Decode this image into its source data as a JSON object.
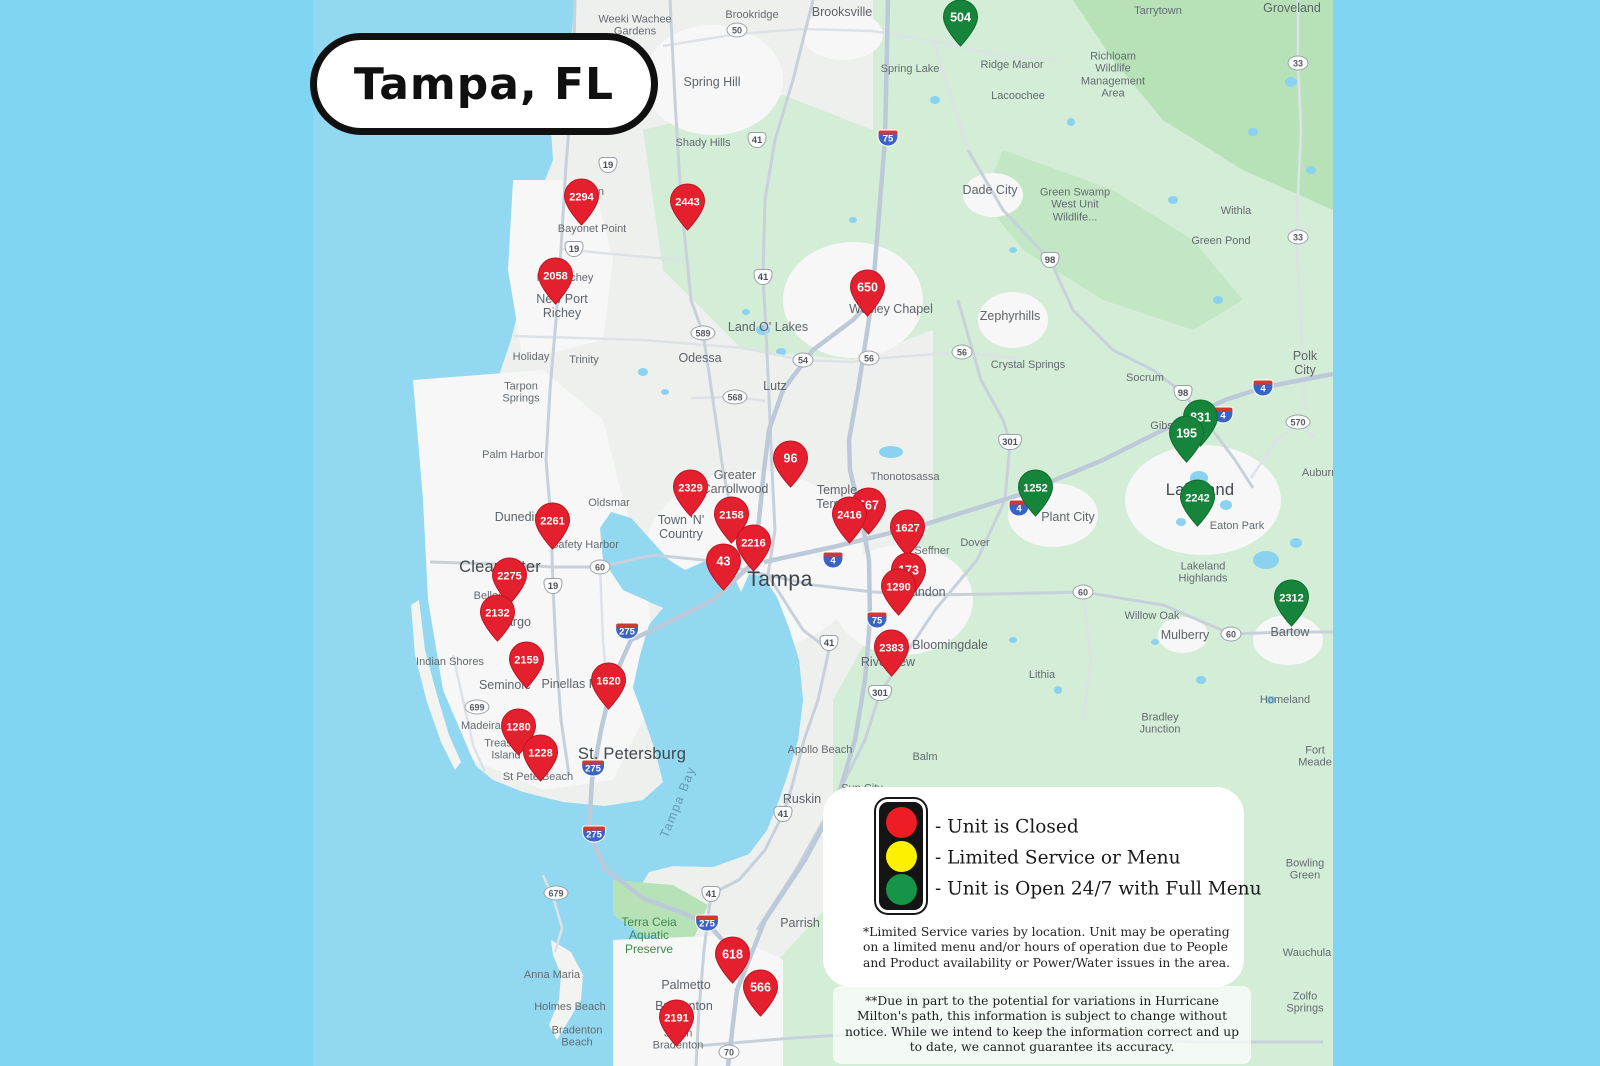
{
  "title_badge": "Tampa, FL",
  "colors": {
    "page_bg": "#7fd5f2",
    "ocean": "#92d8f1",
    "land": "#eef0ee",
    "rural_green": "#d4edd6",
    "park_green": "#b7e2b8",
    "urban": "#f6f7f6",
    "road": "#c7d1dc",
    "road_minor": "#dde2e8",
    "pin": {
      "closed": {
        "fill": "#e4202e",
        "stroke": "#bf1322"
      },
      "open": {
        "fill": "#17843b",
        "stroke": "#0e6b2e"
      }
    }
  },
  "legend": {
    "items": [
      {
        "light": "red",
        "color": "#ee1c24",
        "label": "- Unit is Closed"
      },
      {
        "light": "yellow",
        "color": "#fdf000",
        "label": "- Limited Service or Menu"
      },
      {
        "light": "green",
        "color": "#169447",
        "label": "- Unit is Open 24/7 with Full Menu"
      }
    ],
    "footnote_limited": "*Limited Service varies by location. Unit may be operating on a limited menu and/or hours of operation due to People and Product availability or Power/Water issues in the area.",
    "footnote_hurricane": "**Due in part to the potential for variations in Hurricane Milton's path, this information is subject to change without notice. While we intend to keep the information correct and up to date, we cannot guarantee its accuracy."
  },
  "pins": [
    {
      "id": "504",
      "status": "open",
      "x": 960,
      "y": 17
    },
    {
      "id": "2294",
      "status": "closed",
      "x": 581,
      "y": 196
    },
    {
      "id": "2443",
      "status": "closed",
      "x": 687,
      "y": 201
    },
    {
      "id": "2058",
      "status": "closed",
      "x": 555,
      "y": 275
    },
    {
      "id": "650",
      "status": "closed",
      "x": 867,
      "y": 287
    },
    {
      "id": "831",
      "status": "open",
      "x": 1200,
      "y": 417
    },
    {
      "id": "195",
      "status": "open",
      "x": 1186,
      "y": 433
    },
    {
      "id": "96",
      "status": "closed",
      "x": 790,
      "y": 458
    },
    {
      "id": "1252",
      "status": "open",
      "x": 1035,
      "y": 487
    },
    {
      "id": "2329",
      "status": "closed",
      "x": 690,
      "y": 487
    },
    {
      "id": "2242",
      "status": "open",
      "x": 1197,
      "y": 497
    },
    {
      "id": "567",
      "status": "closed",
      "x": 868,
      "y": 505
    },
    {
      "id": "2416",
      "status": "closed",
      "x": 849,
      "y": 514
    },
    {
      "id": "2158",
      "status": "closed",
      "x": 731,
      "y": 514
    },
    {
      "id": "2261",
      "status": "closed",
      "x": 552,
      "y": 520
    },
    {
      "id": "1627",
      "status": "closed",
      "x": 907,
      "y": 527
    },
    {
      "id": "2216",
      "status": "closed",
      "x": 753,
      "y": 542
    },
    {
      "id": "43",
      "status": "closed",
      "x": 723,
      "y": 561
    },
    {
      "id": "173",
      "status": "closed",
      "x": 908,
      "y": 570
    },
    {
      "id": "2275",
      "status": "closed",
      "x": 509,
      "y": 575
    },
    {
      "id": "1290",
      "status": "closed",
      "x": 898,
      "y": 586
    },
    {
      "id": "2312",
      "status": "open",
      "x": 1291,
      "y": 597
    },
    {
      "id": "2132",
      "status": "closed",
      "x": 497,
      "y": 612
    },
    {
      "id": "2383",
      "status": "closed",
      "x": 891,
      "y": 647
    },
    {
      "id": "2159",
      "status": "closed",
      "x": 526,
      "y": 659
    },
    {
      "id": "1620",
      "status": "closed",
      "x": 608,
      "y": 680
    },
    {
      "id": "1280",
      "status": "closed",
      "x": 518,
      "y": 726
    },
    {
      "id": "1228",
      "status": "closed",
      "x": 540,
      "y": 752
    },
    {
      "id": "618",
      "status": "closed",
      "x": 732,
      "y": 954
    },
    {
      "id": "566",
      "status": "closed",
      "x": 760,
      "y": 987
    },
    {
      "id": "2191",
      "status": "closed",
      "x": 676,
      "y": 1017
    }
  ],
  "map_labels": [
    {
      "text": "Weeki Wachee\nGardens",
      "x": 635,
      "y": 26,
      "cls": "s"
    },
    {
      "text": "Brookridge",
      "x": 752,
      "y": 15,
      "cls": "s"
    },
    {
      "text": "Brooksville",
      "x": 842,
      "y": 12,
      "cls": "m"
    },
    {
      "text": "Tarrytown",
      "x": 1158,
      "y": 11,
      "cls": "s"
    },
    {
      "text": "Groveland",
      "x": 1292,
      "y": 8,
      "cls": "m"
    },
    {
      "text": "Richloam\nWildlife\nManagement\nArea",
      "x": 1113,
      "y": 75,
      "cls": "s"
    },
    {
      "text": "Spring Hill",
      "x": 712,
      "y": 82,
      "cls": "m"
    },
    {
      "text": "Spring Lake",
      "x": 910,
      "y": 69,
      "cls": "s"
    },
    {
      "text": "Ridge Manor",
      "x": 1012,
      "y": 65,
      "cls": "s"
    },
    {
      "text": "Lacoochee",
      "x": 1018,
      "y": 96,
      "cls": "s"
    },
    {
      "text": "Shady Hills",
      "x": 703,
      "y": 143,
      "cls": "s"
    },
    {
      "text": "Dade City",
      "x": 990,
      "y": 190,
      "cls": "m"
    },
    {
      "text": "Green Swamp\nWest Unit\nWildlife...",
      "x": 1075,
      "y": 205,
      "cls": "s"
    },
    {
      "text": "Withla",
      "x": 1236,
      "y": 211,
      "cls": "s"
    },
    {
      "text": "Green Pond",
      "x": 1221,
      "y": 241,
      "cls": "s"
    },
    {
      "text": "Hudson",
      "x": 585,
      "y": 192,
      "cls": "s"
    },
    {
      "text": "Bayonet Point",
      "x": 592,
      "y": 229,
      "cls": "s"
    },
    {
      "text": "Port Richey",
      "x": 565,
      "y": 278,
      "cls": "s"
    },
    {
      "text": "New Port\nRichey",
      "x": 562,
      "y": 306,
      "cls": "m"
    },
    {
      "text": "Wesley Chapel",
      "x": 891,
      "y": 309,
      "cls": "m"
    },
    {
      "text": "Zephyrhills",
      "x": 1010,
      "y": 316,
      "cls": "m"
    },
    {
      "text": "Land O' Lakes",
      "x": 768,
      "y": 327,
      "cls": "m"
    },
    {
      "text": "Odessa",
      "x": 700,
      "y": 358,
      "cls": "m"
    },
    {
      "text": "Holiday",
      "x": 531,
      "y": 357,
      "cls": "s"
    },
    {
      "text": "Trinity",
      "x": 584,
      "y": 360,
      "cls": "s"
    },
    {
      "text": "Crystal Springs",
      "x": 1028,
      "y": 365,
      "cls": "s"
    },
    {
      "text": "Socrum",
      "x": 1145,
      "y": 378,
      "cls": "s"
    },
    {
      "text": "Polk City",
      "x": 1305,
      "y": 363,
      "cls": "m"
    },
    {
      "text": "Tarpon\nSprings",
      "x": 521,
      "y": 393,
      "cls": "s"
    },
    {
      "text": "Lutz",
      "x": 775,
      "y": 386,
      "cls": "m"
    },
    {
      "text": "Palm Harbor",
      "x": 513,
      "y": 455,
      "cls": "s"
    },
    {
      "text": "Thonotosassa",
      "x": 905,
      "y": 477,
      "cls": "s"
    },
    {
      "text": "Greater\nCarrollwood",
      "x": 735,
      "y": 482,
      "cls": "m"
    },
    {
      "text": "Oldsmar",
      "x": 609,
      "y": 503,
      "cls": "s"
    },
    {
      "text": "Temple\nTerrace",
      "x": 837,
      "y": 497,
      "cls": "m"
    },
    {
      "text": "Gibsonia",
      "x": 1172,
      "y": 426,
      "cls": "s"
    },
    {
      "text": "Plant City",
      "x": 1068,
      "y": 517,
      "cls": "m"
    },
    {
      "text": "Lakeland",
      "x": 1200,
      "y": 490,
      "cls": "l"
    },
    {
      "text": "Eaton Park",
      "x": 1237,
      "y": 526,
      "cls": "s"
    },
    {
      "text": "Town 'N'\nCountry",
      "x": 681,
      "y": 527,
      "cls": "m"
    },
    {
      "text": "Dunedin",
      "x": 518,
      "y": 517,
      "cls": "m"
    },
    {
      "text": "Safety Harbor",
      "x": 585,
      "y": 545,
      "cls": "s"
    },
    {
      "text": "Seffner",
      "x": 932,
      "y": 551,
      "cls": "s"
    },
    {
      "text": "Dover",
      "x": 975,
      "y": 543,
      "cls": "s"
    },
    {
      "text": "Clearwater",
      "x": 500,
      "y": 567,
      "cls": "l"
    },
    {
      "text": "Tampa",
      "x": 780,
      "y": 580,
      "cls": "xl"
    },
    {
      "text": "Belleair",
      "x": 492,
      "y": 596,
      "cls": "s"
    },
    {
      "text": "Largo",
      "x": 515,
      "y": 622,
      "cls": "m"
    },
    {
      "text": "Brandon",
      "x": 922,
      "y": 592,
      "cls": "m"
    },
    {
      "text": "Willow Oak",
      "x": 1152,
      "y": 616,
      "cls": "s"
    },
    {
      "text": "Mulberry",
      "x": 1185,
      "y": 635,
      "cls": "m"
    },
    {
      "text": "Bartow",
      "x": 1290,
      "y": 632,
      "cls": "m"
    },
    {
      "text": "Lakeland\nHighlands",
      "x": 1203,
      "y": 573,
      "cls": "s"
    },
    {
      "text": "Auburndale",
      "x": 1330,
      "y": 473,
      "cls": "s"
    },
    {
      "text": "Indian Shores",
      "x": 450,
      "y": 662,
      "cls": "s"
    },
    {
      "text": "Seminole",
      "x": 505,
      "y": 685,
      "cls": "m"
    },
    {
      "text": "Pinellas Park",
      "x": 578,
      "y": 684,
      "cls": "m"
    },
    {
      "text": "Bloomingdale",
      "x": 950,
      "y": 645,
      "cls": "m"
    },
    {
      "text": "Riverview",
      "x": 888,
      "y": 662,
      "cls": "m"
    },
    {
      "text": "Lithia",
      "x": 1042,
      "y": 675,
      "cls": "s"
    },
    {
      "text": "Madeira Beach",
      "x": 498,
      "y": 726,
      "cls": "s"
    },
    {
      "text": "St. Petersburg",
      "x": 632,
      "y": 754,
      "cls": "l"
    },
    {
      "text": "Treasure\nIsland",
      "x": 506,
      "y": 750,
      "cls": "s"
    },
    {
      "text": "St Pete Beach",
      "x": 538,
      "y": 777,
      "cls": "s"
    },
    {
      "text": "Apollo Beach",
      "x": 820,
      "y": 750,
      "cls": "s"
    },
    {
      "text": "Balm",
      "x": 925,
      "y": 757,
      "cls": "s"
    },
    {
      "text": "Homeland",
      "x": 1285,
      "y": 700,
      "cls": "s"
    },
    {
      "text": "Bradley\nJunction",
      "x": 1160,
      "y": 724,
      "cls": "s"
    },
    {
      "text": "Fort Meade",
      "x": 1315,
      "y": 757,
      "cls": "s"
    },
    {
      "text": "Sun City\nCenter",
      "x": 862,
      "y": 795,
      "cls": "s"
    },
    {
      "text": "Ruskin",
      "x": 802,
      "y": 799,
      "cls": "m"
    },
    {
      "text": "Terra Ceia\nAquatic\nPreserve",
      "x": 649,
      "y": 936,
      "cls": "green"
    },
    {
      "text": "Parrish",
      "x": 800,
      "y": 923,
      "cls": "m"
    },
    {
      "text": "Anna Maria",
      "x": 552,
      "y": 975,
      "cls": "s"
    },
    {
      "text": "Palmetto",
      "x": 686,
      "y": 985,
      "cls": "m"
    },
    {
      "text": "Holmes Beach",
      "x": 570,
      "y": 1007,
      "cls": "s"
    },
    {
      "text": "Bradenton\nBeach",
      "x": 577,
      "y": 1037,
      "cls": "s"
    },
    {
      "text": "Bradenton",
      "x": 684,
      "y": 1006,
      "cls": "m"
    },
    {
      "text": "South\nBradenton",
      "x": 678,
      "y": 1040,
      "cls": "s"
    },
    {
      "text": "Bowling Green",
      "x": 1305,
      "y": 870,
      "cls": "s"
    },
    {
      "text": "Wauchula",
      "x": 1307,
      "y": 953,
      "cls": "s"
    },
    {
      "text": "Zolfo Springs",
      "x": 1305,
      "y": 1003,
      "cls": "s"
    },
    {
      "text": "Tampa Bay",
      "x": 678,
      "y": 802,
      "cls": "water",
      "rot": -68
    }
  ],
  "road_shields": [
    {
      "type": "st",
      "num": "50",
      "x": 737,
      "y": 30
    },
    {
      "type": "st",
      "num": "33",
      "x": 1298,
      "y": 63
    },
    {
      "type": "i",
      "num": "75",
      "x": 888,
      "y": 138
    },
    {
      "type": "us",
      "num": "41",
      "x": 757,
      "y": 140
    },
    {
      "type": "us",
      "num": "19",
      "x": 608,
      "y": 165
    },
    {
      "type": "st",
      "num": "33",
      "x": 1298,
      "y": 237
    },
    {
      "type": "us",
      "num": "19",
      "x": 574,
      "y": 249
    },
    {
      "type": "us",
      "num": "98",
      "x": 1050,
      "y": 260
    },
    {
      "type": "us",
      "num": "41",
      "x": 763,
      "y": 277
    },
    {
      "type": "st",
      "num": "589",
      "x": 703,
      "y": 333
    },
    {
      "type": "st",
      "num": "54",
      "x": 803,
      "y": 360
    },
    {
      "type": "st",
      "num": "56",
      "x": 869,
      "y": 358
    },
    {
      "type": "st",
      "num": "56",
      "x": 962,
      "y": 352
    },
    {
      "type": "us",
      "num": "98",
      "x": 1183,
      "y": 393
    },
    {
      "type": "st",
      "num": "568",
      "x": 735,
      "y": 397
    },
    {
      "type": "i",
      "num": "4",
      "x": 1263,
      "y": 388
    },
    {
      "type": "i",
      "num": "4",
      "x": 1223,
      "y": 415
    },
    {
      "type": "st",
      "num": "570",
      "x": 1298,
      "y": 422
    },
    {
      "type": "us",
      "num": "301",
      "x": 1010,
      "y": 442
    },
    {
      "type": "i",
      "num": "4",
      "x": 1019,
      "y": 508
    },
    {
      "type": "i",
      "num": "4",
      "x": 833,
      "y": 560
    },
    {
      "type": "st",
      "num": "60",
      "x": 600,
      "y": 567
    },
    {
      "type": "us",
      "num": "19",
      "x": 553,
      "y": 586
    },
    {
      "type": "st",
      "num": "60",
      "x": 1083,
      "y": 592
    },
    {
      "type": "i",
      "num": "75",
      "x": 877,
      "y": 620
    },
    {
      "type": "i",
      "num": "275",
      "x": 627,
      "y": 631
    },
    {
      "type": "st",
      "num": "60",
      "x": 1231,
      "y": 634
    },
    {
      "type": "us",
      "num": "41",
      "x": 829,
      "y": 643
    },
    {
      "type": "us",
      "num": "301",
      "x": 880,
      "y": 693
    },
    {
      "type": "st",
      "num": "699",
      "x": 477,
      "y": 707
    },
    {
      "type": "i",
      "num": "275",
      "x": 593,
      "y": 768
    },
    {
      "type": "us",
      "num": "41",
      "x": 783,
      "y": 814
    },
    {
      "type": "i",
      "num": "275",
      "x": 594,
      "y": 834
    },
    {
      "type": "st",
      "num": "679",
      "x": 556,
      "y": 893
    },
    {
      "type": "us",
      "num": "41",
      "x": 711,
      "y": 894
    },
    {
      "type": "i",
      "num": "275",
      "x": 707,
      "y": 923
    },
    {
      "type": "st",
      "num": "70",
      "x": 729,
      "y": 1052
    }
  ]
}
